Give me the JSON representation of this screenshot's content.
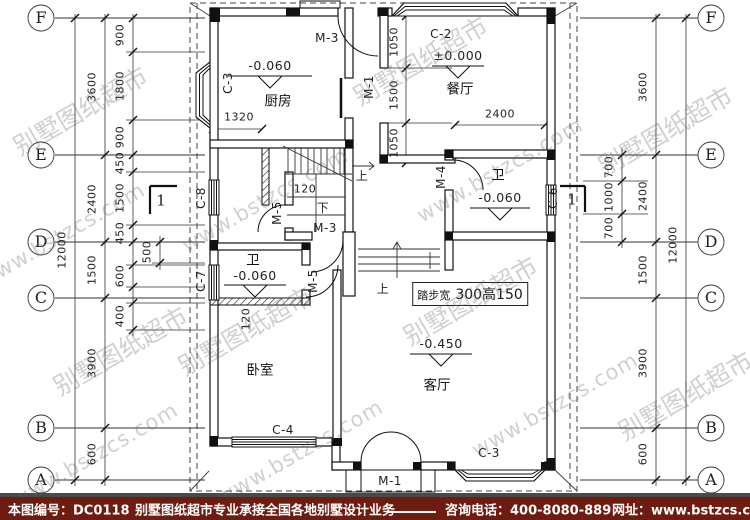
{
  "watermark": {
    "line1": "别墅图纸超市",
    "line2": "www.bstzcs.com"
  },
  "grid": {
    "letters": [
      "F",
      "E",
      "D",
      "C",
      "B",
      "A"
    ]
  },
  "dims": {
    "left_total": "12000",
    "left_main": [
      "3600",
      "2400",
      "1500",
      "3900",
      "600"
    ],
    "left_inner": [
      "900",
      "1800",
      "900",
      "450",
      "1500",
      "450",
      "600",
      "400"
    ],
    "left_inner2": "500",
    "right_total": "12000",
    "right_main": [
      "3600",
      "2400",
      "1500",
      "3900",
      "600"
    ],
    "right_inner": [
      "700",
      "1000",
      "700"
    ],
    "dining_vertical": [
      "1050",
      "1500",
      "1050"
    ],
    "dining_width": "2400",
    "kitchen_width": "1320",
    "stair_offset": "120",
    "bedroom_offset": "120"
  },
  "rooms": {
    "kitchen": "厨房",
    "dining": "餐厅",
    "living": "客厅",
    "bedroom": "卧室",
    "bath_upper": "卫",
    "bath_lower": "卫"
  },
  "elevations": {
    "kitchen": "-0.060",
    "dining": "±0.000",
    "bath_upper": "-0.060",
    "bath_lower": "-0.060",
    "living": "-0.450"
  },
  "doors": {
    "m1": "M-1",
    "m3": "M-3",
    "m4": "M-4",
    "m5": "M-5"
  },
  "windows": {
    "c2": "C-2",
    "c3": "C-3",
    "c4": "C-4",
    "c6": "C-6",
    "c7": "C-7",
    "c8": "C-8"
  },
  "stairs": {
    "up": "上",
    "down": "下",
    "note_prefix": "踏步宽",
    "note_value": "300高150"
  },
  "section": {
    "label": "1"
  },
  "footer": {
    "sheet_no": "本图编号：DC0118",
    "service": "别墅图纸超市专业承接全国各地别墅设计业务",
    "phone": "咨询电话：400-8080-889",
    "site": "网址：www.bstzcs.com"
  }
}
